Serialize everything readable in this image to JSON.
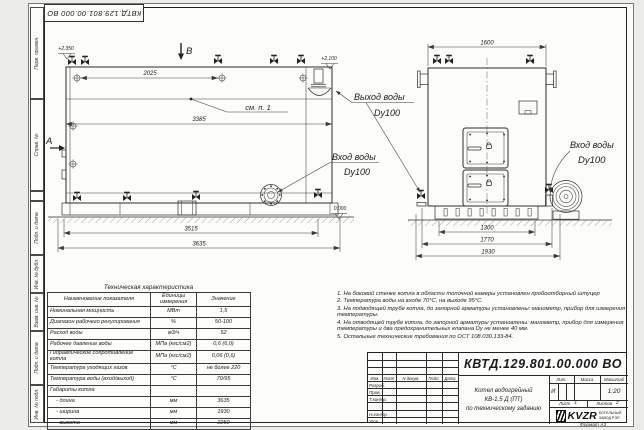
{
  "corner_ref": "КВТД.129.801.00.000  ВО",
  "stamp_column": [
    "Перв. примен.",
    "Справ. №",
    "",
    "Подп. и дата",
    "Инв. № дубл.",
    "Взам. инв. №",
    "Подп. и дата",
    "Инв. № подл."
  ],
  "drawing": {
    "section_a": "А",
    "section_b": "В",
    "elev_top": "+2.350",
    "elev_outlet": "+2.100",
    "elev_zero": "0.000",
    "callout": "см. п. 1",
    "dims": {
      "d2025": "2025",
      "d3385": "3385",
      "d3515": "3515",
      "d3635": "3635",
      "d1600": "1600",
      "d1300": "1300",
      "d1770": "1770",
      "d1930": "1930"
    },
    "labels": {
      "outlet": "Выход воды",
      "outlet_dn": "Dy100",
      "inlet_side": "Вход воды",
      "inlet_side_dn": "Dy100",
      "inlet_front": "Вход воды",
      "inlet_front_dn": "Dy100"
    }
  },
  "spec_table": {
    "title": "Техническая характеристика",
    "headers": [
      "Наименование показателя",
      "Единицы измерения",
      "Значение"
    ],
    "rows": [
      [
        "Номинальная мощность",
        "МВт",
        "1,5"
      ],
      [
        "Диапазон рабочего регулирования",
        "%",
        "50-100"
      ],
      [
        "Расход воды",
        "м3/ч",
        "52"
      ],
      [
        "Рабочее давление воды",
        "МПа (кгс/см2)",
        "0,6 (6,0)"
      ],
      [
        "Гидравлическое сопротивление котла",
        "МПа (кгс/см2)",
        "0,06 (0,6)"
      ],
      [
        "Температура уходящих газов",
        "°С",
        "не более 220"
      ],
      [
        "Температура воды (вход/выход)",
        "°С",
        "70/95"
      ],
      [
        "Габариты котла",
        "",
        ""
      ],
      [
        "    - длина",
        "мм",
        "3635"
      ],
      [
        "    - ширина",
        "мм",
        "1930"
      ],
      [
        "    - высота",
        "мм",
        "2250"
      ]
    ]
  },
  "notes": [
    "1.  На боковой стенке котла в области топочной камеры установлен пробоотборный штуцер",
    "2.  Температура воды на входе 70°С, на выходе 95°С.",
    "3.  На подводящей трубе котла, до запорной арматуры установлены: манометр, прибор для измерения температуры.",
    "4.  На отводящей трубе котла, до запорной арматуры установлены: манометр, прибор для измерения температуры и два предохранительных клапана Dу не менее 40 мм.",
    "5.  Остальные технические требования по ОСТ 108.030.133-84."
  ],
  "title_block": {
    "number": "КВТД.129.801.00.000  ВО",
    "product_lines": [
      "Котел водогрейный",
      "КВ-1,5  Д  (ПТ)",
      "по техническому заданию"
    ],
    "header_cols": [
      "Изм.",
      "Лист",
      "N докум.",
      "Подп.",
      "Дата"
    ],
    "sign_rows": [
      "Разраб.",
      "Пров.",
      "Т.контр.",
      "",
      "Н.контр.",
      "Утв."
    ],
    "lit_label": "Лит.",
    "mass_label": "Масса",
    "scale_label": "Масштаб",
    "lit_value": "И",
    "scale_value": "1:20",
    "sheet_label": "Лист",
    "sheet_value": "1",
    "sheets_label": "Листов",
    "sheets_value": "2",
    "brand": "KVZR",
    "brand_sub1": "КОТЕЛЬНЫЙ",
    "brand_sub2": "ЗАВОД РЭП",
    "format_note": "Формат  А3"
  }
}
